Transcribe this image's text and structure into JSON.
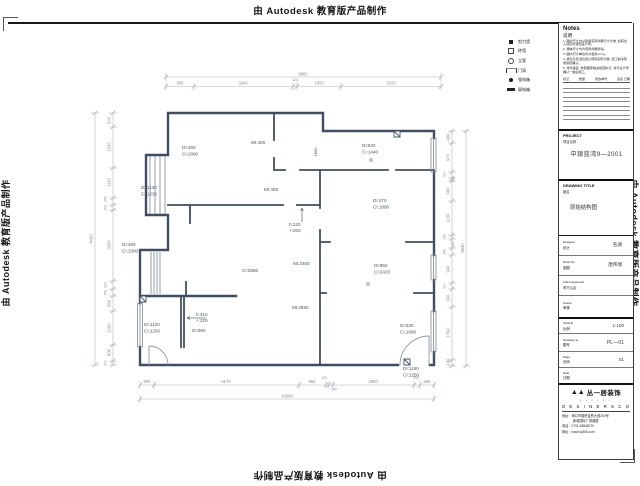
{
  "watermark": {
    "text": "由 Autodesk 教育版产品制作"
  },
  "legend": {
    "items": [
      {
        "icon": "filled-square",
        "label": "剪力墙"
      },
      {
        "icon": "open-square",
        "label": "砖墙"
      },
      {
        "icon": "circle",
        "label": "立管"
      },
      {
        "icon": "door-opening",
        "label": "门洞"
      },
      {
        "icon": "filled-dot",
        "label": "强电箱"
      },
      {
        "icon": "thick-bar",
        "label": "弱电箱"
      }
    ]
  },
  "notes": {
    "title": "Notes",
    "subtitle": "说明",
    "items": [
      "1. 图中尺寸均以现场实际测量尺寸为准, 如有出入请及时通知设计师。",
      "2. 墙体尺寸均为现场测量所得。",
      "3. 图中尺寸单位均为毫米(mm)。",
      "4. 梁位及管道位置以现场实际为准, 施工前请现场复核确认。",
      "5. 未尽事宜, 参照国家相关规范执行, 并与设计师确认一致后施工。"
    ],
    "rev_cols": [
      "标记",
      "数量",
      "修改单号",
      "签名  日期"
    ]
  },
  "title_block": {
    "project": {
      "en": "PROJECT",
      "cn": "项目名称",
      "value": "中银蓝湾9—2001"
    },
    "drawing_title": {
      "en": "DRAWING TITLE",
      "cn": "图名",
      "value": "原始结构图"
    },
    "rows": [
      {
        "en": "Designer",
        "cn": "设计",
        "value": "名湖"
      },
      {
        "en": "Draw No",
        "cn": "制图",
        "value": "唐伟瑞"
      },
      {
        "en": "Client approved",
        "cn": "甲方认定",
        "value": ""
      },
      {
        "en": "Check",
        "cn": "审核",
        "value": ""
      }
    ],
    "meta": [
      {
        "en": "SCALE",
        "cn": "比例",
        "value": "1:100"
      },
      {
        "en": "Drawing  no",
        "cn": "图号",
        "value": "PL—01"
      },
      {
        "en": "Page",
        "cn": "页码",
        "value": "01"
      },
      {
        "en": "Date",
        "cn": "日期",
        "value": ""
      }
    ],
    "company": {
      "logo_mark": "▲▲",
      "name": "丛一居装饰",
      "dots": "▪ ▪ ▪ ▪ ▪ ▪",
      "tagline": "D E S I N E R S   C O",
      "address1": "地址：海口市国贸金贸大道200号",
      "address2": "新城国际广场裙楼",
      "phone": "电话：0791-63848270",
      "web": "网址：www.xy365.com"
    }
  },
  "plan": {
    "texts": [
      {
        "t": "DI:490",
        "x": 182,
        "y": 149
      },
      {
        "t": "CI:1890",
        "x": 182,
        "y": 155.5
      },
      {
        "t": "MI:408",
        "x": 251,
        "y": 144
      },
      {
        "t": "MI:408",
        "x": 264,
        "y": 191
      },
      {
        "t": "DI:930",
        "x": 362,
        "y": 147
      },
      {
        "t": "CI:1440",
        "x": 362,
        "y": 153.5
      },
      {
        "t": "DI:1130",
        "x": 141,
        "y": 189
      },
      {
        "t": "CI:1230",
        "x": 141,
        "y": 195.5
      },
      {
        "t": "DI:490",
        "x": 122,
        "y": 246
      },
      {
        "t": "CI:1900",
        "x": 122,
        "y": 252.5
      },
      {
        "t": "DI:470",
        "x": 373,
        "y": 202
      },
      {
        "t": "CI:1890",
        "x": 373,
        "y": 208.5
      },
      {
        "t": "h:220",
        "x": 289,
        "y": 226
      },
      {
        "t": "+:200",
        "x": 289,
        "y": 232
      },
      {
        "t": "CI:2860",
        "x": 242,
        "y": 272
      },
      {
        "t": "MI:2450",
        "x": 293,
        "y": 265
      },
      {
        "t": "DI:960",
        "x": 374,
        "y": 267
      },
      {
        "t": "CI:2420",
        "x": 374,
        "y": 273.5
      },
      {
        "t": "MI:2850",
        "x": 292,
        "y": 309
      },
      {
        "t": "DI:530",
        "x": 400,
        "y": 327
      },
      {
        "t": "CI:1890",
        "x": 400,
        "y": 333.5
      },
      {
        "t": "DI:1120",
        "x": 144,
        "y": 326
      },
      {
        "t": "CI:1250",
        "x": 144,
        "y": 332.5
      },
      {
        "t": "h:310",
        "x": 196,
        "y": 316
      },
      {
        "t": "+:220",
        "x": 196,
        "y": 322
      },
      {
        "t": "DI:950",
        "x": 192,
        "y": 332
      },
      {
        "t": "DI:1150",
        "x": 403,
        "y": 370
      },
      {
        "t": "CI:1250",
        "x": 403,
        "y": 376.5
      },
      {
        "t": "1890",
        "x": 317,
        "y": 152,
        "r": -90,
        "a": "m",
        "s": 4
      },
      {
        "t": "9960",
        "x": 303,
        "y": 75.5,
        "a": "m",
        "c": "d"
      },
      {
        "t": "900",
        "x": 180,
        "y": 84.5,
        "a": "m",
        "c": "d"
      },
      {
        "t": "3240",
        "x": 243,
        "y": 84.5,
        "a": "m",
        "c": "d"
      },
      {
        "t": "120",
        "x": 295,
        "y": 81,
        "a": "m",
        "c": "d",
        "s": 3.5
      },
      {
        "t": "1600",
        "x": 319,
        "y": 84.5,
        "a": "m",
        "c": "d"
      },
      {
        "t": "3200",
        "x": 391,
        "y": 84.5,
        "a": "m",
        "c": "d"
      },
      {
        "t": "10090",
        "x": 287,
        "y": 397.5,
        "a": "m",
        "c": "d"
      },
      {
        "t": "500",
        "x": 147,
        "y": 383,
        "a": "m",
        "c": "d"
      },
      {
        "t": "5170",
        "x": 226,
        "y": 383,
        "a": "m",
        "c": "d"
      },
      {
        "t": "960",
        "x": 312,
        "y": 383,
        "a": "m",
        "c": "d"
      },
      {
        "t": "120",
        "x": 324,
        "y": 379,
        "a": "m",
        "c": "d",
        "s": 3.4
      },
      {
        "t": "140",
        "x": 334,
        "y": 390.5,
        "a": "m",
        "c": "d",
        "s": 3.4
      },
      {
        "t": "2900",
        "x": 373,
        "y": 383,
        "a": "m",
        "c": "d"
      },
      {
        "t": "200",
        "x": 416,
        "y": 379,
        "a": "m",
        "c": "d",
        "s": 3.4
      },
      {
        "t": "550",
        "x": 427,
        "y": 383,
        "a": "m",
        "c": "d"
      },
      {
        "t": "520",
        "x": 110.5,
        "y": 120.5,
        "r": -90,
        "a": "m",
        "c": "d"
      },
      {
        "t": "1530",
        "x": 110.5,
        "y": 147,
        "r": -90,
        "a": "m",
        "c": "d"
      },
      {
        "t": "1110",
        "x": 110.5,
        "y": 182.5,
        "r": -90,
        "a": "m",
        "c": "d"
      },
      {
        "t": "260",
        "x": 106.5,
        "y": 199,
        "r": -90,
        "a": "m",
        "c": "d",
        "s": 3.4
      },
      {
        "t": "200",
        "x": 106.5,
        "y": 207.5,
        "r": -90,
        "a": "m",
        "c": "d",
        "s": 3.4
      },
      {
        "t": "2650",
        "x": 110.5,
        "y": 245,
        "r": -90,
        "a": "m",
        "c": "d"
      },
      {
        "t": "300",
        "x": 106.5,
        "y": 285,
        "r": -90,
        "a": "m",
        "c": "d",
        "s": 3.4
      },
      {
        "t": "250",
        "x": 106.5,
        "y": 292.5,
        "r": -90,
        "a": "m",
        "c": "d",
        "s": 3.4
      },
      {
        "t": "550",
        "x": 110.5,
        "y": 303.5,
        "r": -90,
        "a": "m",
        "c": "d"
      },
      {
        "t": "1260",
        "x": 110.5,
        "y": 328,
        "r": -90,
        "a": "m",
        "c": "d"
      },
      {
        "t": "600",
        "x": 110.5,
        "y": 352.5,
        "r": -90,
        "a": "m",
        "c": "d"
      },
      {
        "t": "200",
        "x": 106.5,
        "y": 363,
        "r": -90,
        "a": "m",
        "c": "d",
        "s": 3.4
      },
      {
        "t": "9430",
        "x": 92.5,
        "y": 239,
        "r": -90,
        "a": "m",
        "c": "d"
      },
      {
        "t": "400",
        "x": 449.5,
        "y": 137,
        "r": -90,
        "a": "m",
        "c": "d"
      },
      {
        "t": "970",
        "x": 449.5,
        "y": 157.5,
        "r": -90,
        "a": "m",
        "c": "d"
      },
      {
        "t": "200",
        "x": 445.5,
        "y": 174,
        "r": -90,
        "a": "m",
        "c": "d",
        "s": 3.4
      },
      {
        "t": "100",
        "x": 454,
        "y": 179.5,
        "r": -90,
        "a": "m",
        "c": "d",
        "s": 3.4
      },
      {
        "t": "690",
        "x": 449.5,
        "y": 191,
        "r": -90,
        "a": "m",
        "c": "d"
      },
      {
        "t": "1150",
        "x": 449.5,
        "y": 218,
        "r": -90,
        "a": "m",
        "c": "d"
      },
      {
        "t": "140",
        "x": 445.5,
        "y": 237,
        "r": -90,
        "a": "m",
        "c": "d",
        "s": 3.4
      },
      {
        "t": "290",
        "x": 454,
        "y": 243.5,
        "r": -90,
        "a": "m",
        "c": "d",
        "s": 3.4
      },
      {
        "t": "240",
        "x": 445.5,
        "y": 251.5,
        "r": -90,
        "a": "m",
        "c": "d",
        "s": 3.4
      },
      {
        "t": "940",
        "x": 449.5,
        "y": 269,
        "r": -90,
        "a": "m",
        "c": "d"
      },
      {
        "t": "200",
        "x": 445.5,
        "y": 286,
        "r": -90,
        "a": "m",
        "c": "d",
        "s": 3.4
      },
      {
        "t": "600",
        "x": 449.5,
        "y": 298,
        "r": -90,
        "a": "m",
        "c": "d"
      },
      {
        "t": "1790",
        "x": 449.5,
        "y": 333,
        "r": -90,
        "a": "m",
        "c": "d"
      },
      {
        "t": "190",
        "x": 449.5,
        "y": 362,
        "r": -90,
        "a": "m",
        "c": "d"
      },
      {
        "t": "8930",
        "x": 464,
        "y": 248,
        "r": -90,
        "a": "m",
        "c": "d"
      }
    ]
  }
}
